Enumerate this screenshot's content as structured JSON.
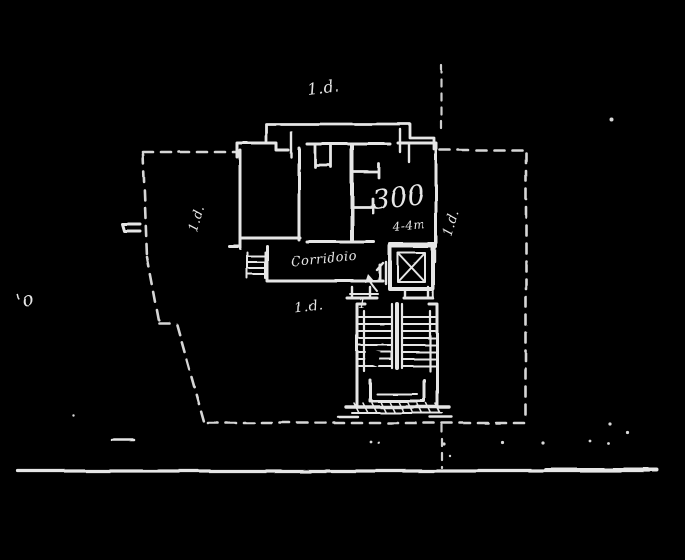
{
  "canvas": {
    "width": 685,
    "height": 560,
    "background_color": "#000000",
    "ink_color": "#e6e6e6"
  },
  "drawing": {
    "labels": {
      "note_top": "1.d.",
      "note_left": "1.d.",
      "note_right": "1.d.",
      "note_bottom": "1.d.",
      "dimension_main": "300",
      "dimension_sub": "4-4m",
      "corridor": "Corridoio",
      "margin_note": "'o",
      "stair_number": "1"
    }
  }
}
